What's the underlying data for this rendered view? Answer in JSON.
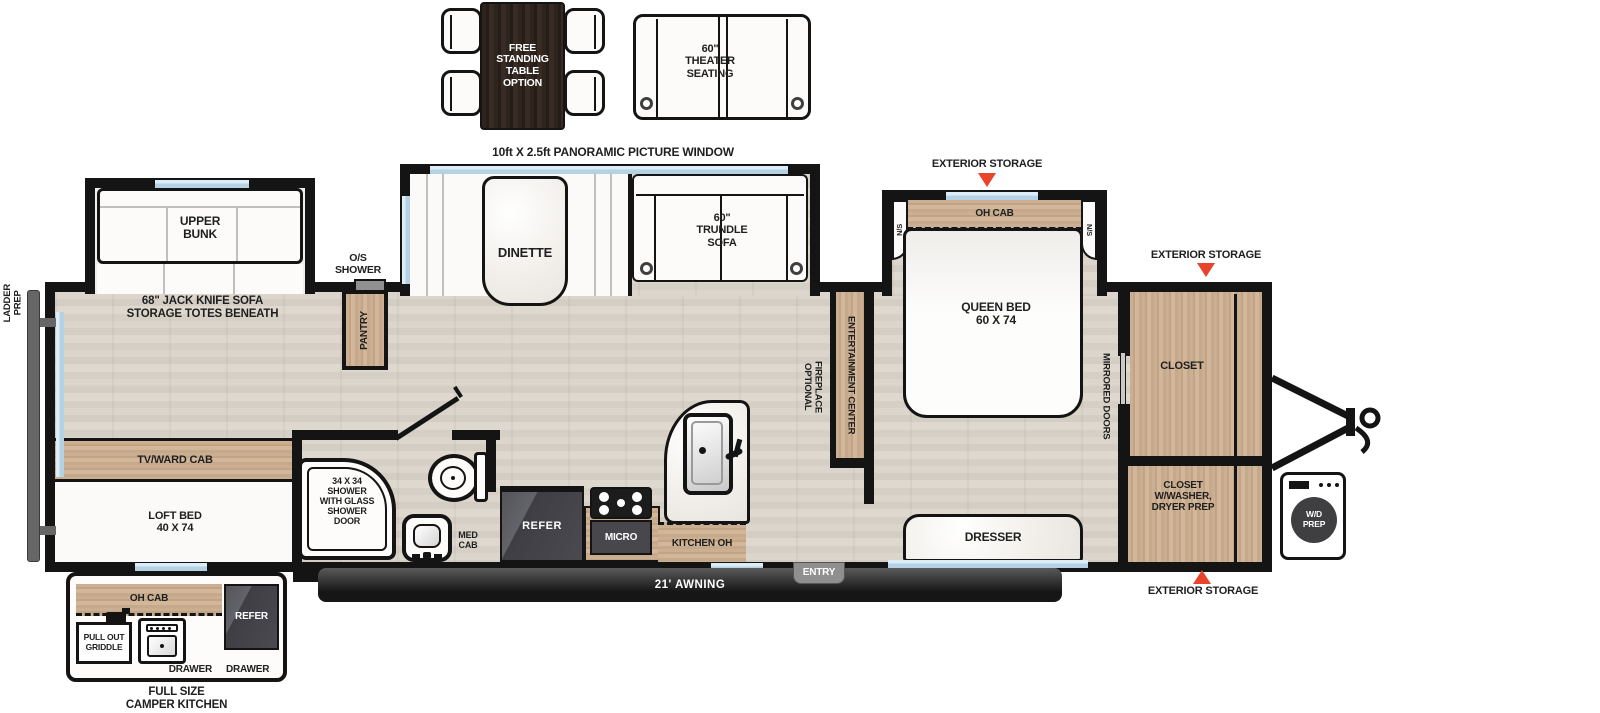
{
  "colors": {
    "wall": "#141414",
    "window_blue": "#b5d1e4",
    "storage_triangle": "#e8432b",
    "floor_wood": "#d7d1c7",
    "cabinet_wood": "#c8ac8e",
    "appliance_dark": "#48484c",
    "awning_dark": "#2b2b2b",
    "entry_gray": "#8f8f8f"
  },
  "options": {
    "free_standing_table": "FREE\nSTANDING\nTABLE\nOPTION",
    "theater_seating": "60\"\nTHEATER\nSEATING"
  },
  "callouts": {
    "panoramic_window": "10ft X 2.5ft PANORAMIC PICTURE WINDOW",
    "exterior_storage_top": "EXTERIOR STORAGE",
    "exterior_storage_right": "EXTERIOR STORAGE",
    "exterior_storage_bottom": "EXTERIOR STORAGE",
    "ladder_prep": "LADDER\nPREP"
  },
  "living_area": {
    "upper_bunk": "UPPER\nBUNK",
    "jack_knife_sofa": "68\" JACK KNIFE SOFA\nSTORAGE TOTES BENEATH",
    "os_shower": "O/S\nSHOWER",
    "pantry": "PANTRY",
    "dinette": "DINETTE",
    "trundle_sofa": "60\"\nTRUNDLE\nSOFA",
    "tv_ward_cab": "TV/WARD CAB",
    "loft_bed": "LOFT BED\n40 X 74",
    "entertainment_center": "ENTERTAINMENT CENTER",
    "optional_fireplace": "OPTIONAL\nFIREPLACE"
  },
  "bathroom": {
    "shower": "34 X 34\nSHOWER\nWITH GLASS\nSHOWER\nDOOR",
    "med_cab": "MED\nCAB"
  },
  "kitchen": {
    "refer": "REFER",
    "micro": "MICRO",
    "kitchen_oh": "KITCHEN OH"
  },
  "bedroom": {
    "oh_cab": "OH CAB",
    "ns_left": "N/S",
    "ns_right": "N/S",
    "queen_bed": "QUEEN BED\n60 X 74",
    "dresser": "DRESSER",
    "mirrored_doors": "MIRRORED DOORS",
    "closet": "CLOSET",
    "closet_washer": "CLOSET\nW/WASHER,\nDRYER PREP",
    "wd_prep": "W/D\nPREP"
  },
  "exterior": {
    "awning": "21' AWNING",
    "entry": "ENTRY"
  },
  "camper_kitchen": {
    "oh_cab": "OH CAB",
    "pull_out_griddle": "PULL OUT\nGRIDDLE",
    "refer": "REFER",
    "drawer_left": "DRAWER",
    "drawer_right": "DRAWER",
    "caption": "FULL SIZE\nCAMPER KITCHEN"
  }
}
